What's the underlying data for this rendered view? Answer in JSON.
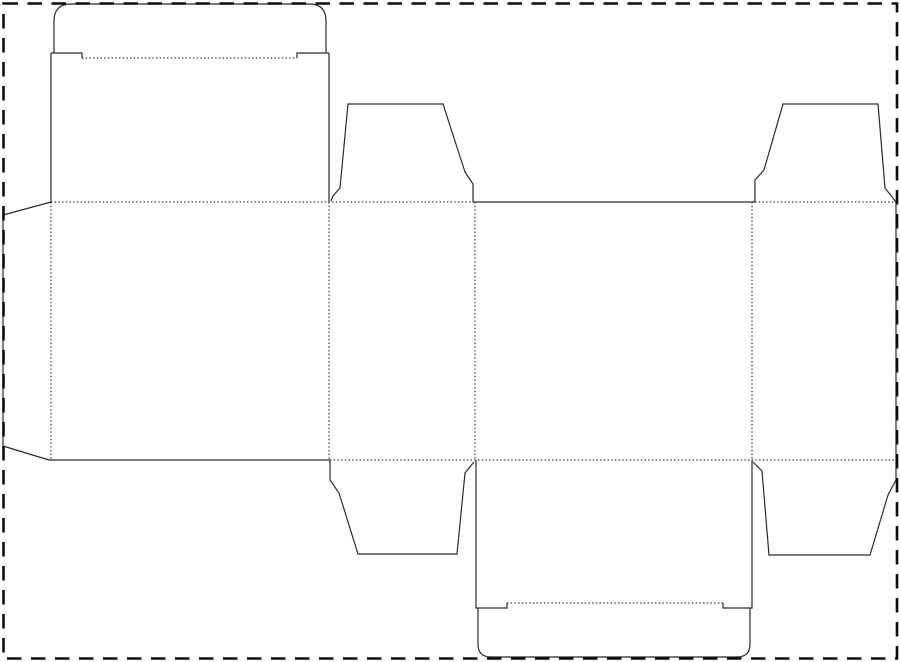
{
  "diagram": {
    "type": "packaging-dieline",
    "subject": "tuck-top-carton-template"
  },
  "canvas": {
    "width": 900,
    "height": 662,
    "background": "#ffffff"
  },
  "colors": {
    "cut_line": "#2b2b2b",
    "fold_line": "#333333",
    "border": "#0d0d0d"
  },
  "border": {
    "x": 3.5,
    "y": 3.5,
    "width": 893.5,
    "height": 655,
    "stroke_width": 2.6,
    "dash": "14.5 9.5"
  },
  "dieline": {
    "stroke_width": 1.2,
    "fold_dash": "1.4 2.3",
    "cuts": [
      {
        "name": "tuck-flap-outline",
        "d": "M 54,53 L 54,21 Q 54,4 71,4 L 309,4 Q 326,4 326,21 L 326,53"
      },
      {
        "name": "tuck-flap-left-shoulder",
        "d": "M 51,53 L 82,53 L 82,58"
      },
      {
        "name": "tuck-flap-right-shoulder",
        "d": "M 297,58 L 297,53 L 329,53"
      },
      {
        "name": "lid-panel-left-edge",
        "d": "M 51,53 L 51,202"
      },
      {
        "name": "lid-panel-right-edge",
        "d": "M 329,53 L 329,202"
      },
      {
        "name": "glue-flap-outline",
        "d": "M 51,202 L 3,215 L 3,446 L 49,460"
      },
      {
        "name": "front-panel-bottom-edge",
        "d": "M 49,460 L 330,460"
      },
      {
        "name": "dust-flap-top-left",
        "d": "M 331,201 L 333,196 L 340,188 L 348,104 L 443,104 L 465,172 L 473,184 L 473,202"
      },
      {
        "name": "side-panel-top-edge",
        "d": "M 473,202 L 755,202"
      },
      {
        "name": "dust-flap-top-right",
        "d": "M 755,202 L 755,180 L 764,170 L 783,104 L 878,104 L 885,188 L 896,202"
      },
      {
        "name": "right-panel-right-edge",
        "d": "M 896,202 L 896,480"
      },
      {
        "name": "dust-flap-bottom-right",
        "d": "M 896,480 L 888,495 L 870,555 L 769,555 L 762,471 L 753,462"
      },
      {
        "name": "dust-flap-bottom-left",
        "d": "M 330,460 L 330,480 L 339,493 L 358,554 L 457,554 L 465,473 L 474,462"
      },
      {
        "name": "bottom-panel-left-edge",
        "d": "M 476,460 L 476,608 L 507,608 L 507,603"
      },
      {
        "name": "bottom-panel-right-edge",
        "d": "M 752,460 L 752,608 L 723,608 L 723,603"
      },
      {
        "name": "bottom-tuck-flap-outline",
        "d": "M 478,608 L 478,644 Q 478,657 491,657 L 737,657 Q 750,657 750,644 L 750,608"
      }
    ],
    "folds": [
      {
        "name": "tuck-flap-fold",
        "d": "M 82,58 L 297,58"
      },
      {
        "name": "top-fold-left-run",
        "d": "M 51,202 L 473,202"
      },
      {
        "name": "top-fold-right-run",
        "d": "M 755,202 L 896,202"
      },
      {
        "name": "bottom-fold-run",
        "d": "M 330,460 L 896,460"
      },
      {
        "name": "vertical-fold-glue",
        "d": "M 51,202 L 51,460"
      },
      {
        "name": "vertical-fold-panel-2",
        "d": "M 329,202 L 329,460"
      },
      {
        "name": "vertical-fold-panel-3",
        "d": "M 475,202 L 475,460"
      },
      {
        "name": "vertical-fold-panel-4",
        "d": "M 752,202 L 752,460"
      },
      {
        "name": "bottom-tuck-fold",
        "d": "M 507,603 L 723,603"
      }
    ]
  }
}
